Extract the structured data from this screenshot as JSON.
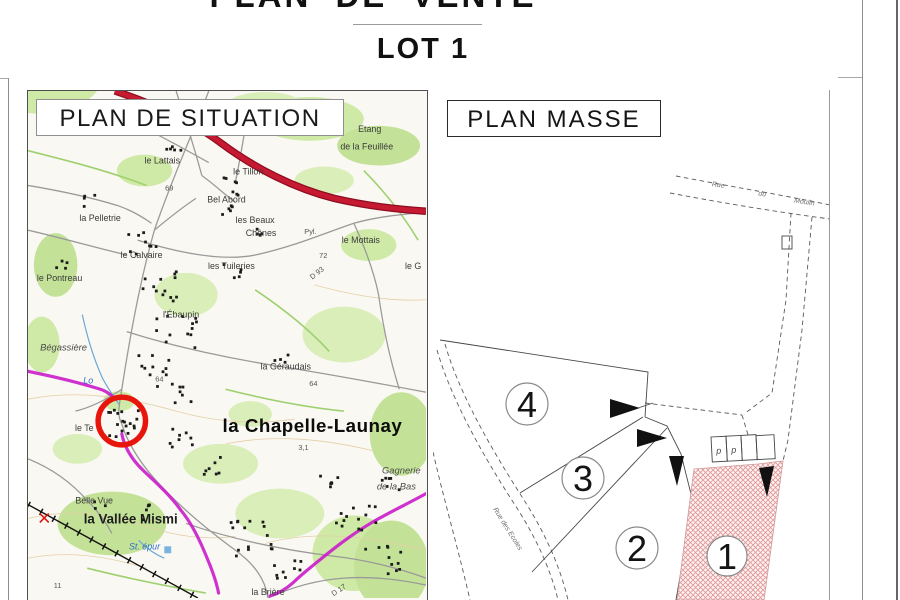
{
  "title_block": {
    "title": "PLAN DE VENTE",
    "lot_label": "LOT 1"
  },
  "situation_panel": {
    "panel_title": "PLAN DE SITUATION",
    "map_labels": {
      "etang_1": "Etang",
      "etang_2": "de la Feuillée",
      "le_lattais": "le Lattais",
      "le_tillon": "le Tillon",
      "n69": "69",
      "bel_abord": "Bel Abord",
      "les_beaux": "les Beaux",
      "chenes": "Chênes",
      "la_pelletrie": "la Pelletrie",
      "le_calvaire": "le Calvaire",
      "les_tuileries": "les Tuileries",
      "le_pontreau": "le Pontreau",
      "pyl": "Pyl.",
      "le_mottais": "le Mottais",
      "n72": "72",
      "d93": "D 93",
      "le_g": "le G",
      "l_ebaupin": "l'Ébaupin",
      "begassiere": "Bégassière",
      "la_geraudais": "la Géraudais",
      "n64_a": "64",
      "n64_b": "64",
      "lo": "Lo",
      "le_te": "le Te",
      "la_chapelle_launay": "la Chapelle-Launay",
      "n31": "3,1",
      "gagnerie_1": "Gagnerie",
      "gagnerie_2": "de la Bas",
      "belle_vue": "Belle Vue",
      "la_vallee_mismi": "la Vallée Mismi",
      "st_epur": "St. épur",
      "la_briere": "la Brière",
      "n11": "11",
      "d17": "D 17"
    }
  },
  "masse_panel": {
    "panel_title": "PLAN MASSE",
    "street_top_words": {
      "w1": "Rue",
      "w2": "du",
      "w3": "Moulin"
    },
    "street_left": "Rue des Ecoles",
    "lot_numbers": {
      "lot1": "1",
      "lot2": "2",
      "lot3": "3",
      "lot4": "4"
    },
    "parking": {
      "p1": "p",
      "p2": "p"
    }
  },
  "colors": {
    "highlight_hatch": "#e09595",
    "road_red": "#c01030",
    "gr_magenta": "#cb1fcb",
    "marker_red": "#e8150d",
    "map_green": "#cfe9a6"
  }
}
